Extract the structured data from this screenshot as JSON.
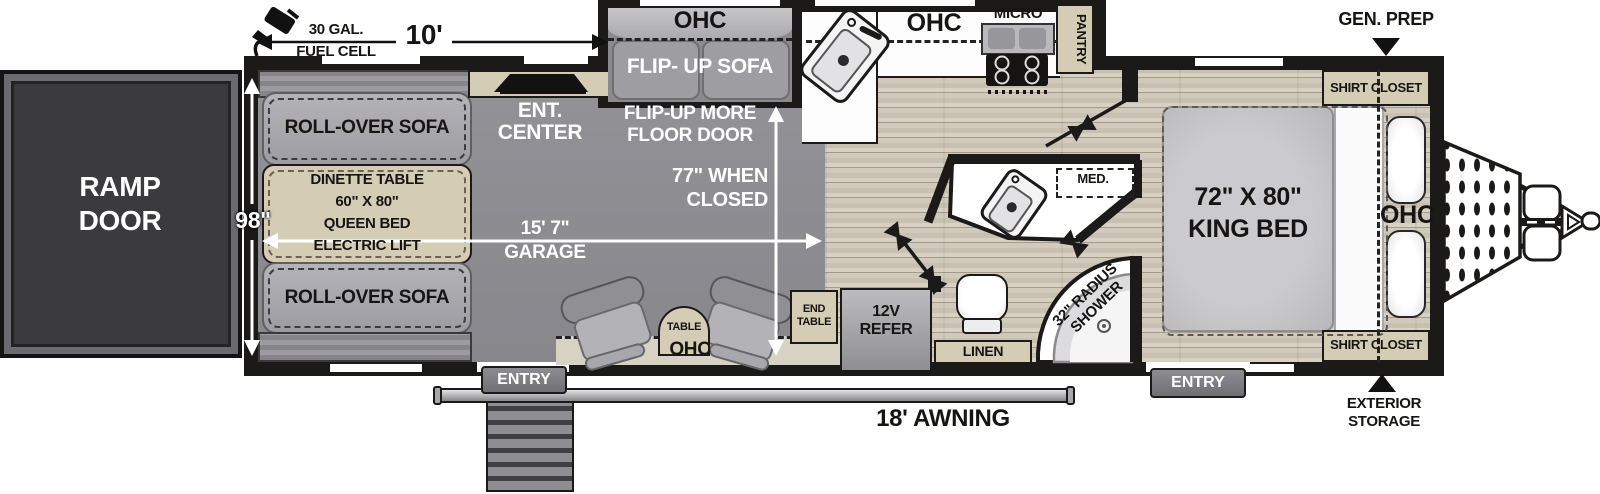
{
  "annotations": {
    "fuel": {
      "line1": "30 GAL.",
      "line2": "FUEL CELL"
    },
    "front_length": "10'",
    "body_width": "98\"",
    "garage_length": {
      "line1": "15' 7\"",
      "line2": "GARAGE"
    },
    "closed_height": {
      "line1": "77\" WHEN",
      "line2": "CLOSED"
    },
    "awning": "18' AWNING",
    "gen_prep": "GEN. PREP",
    "exterior_storage": {
      "line1": "EXTERIOR",
      "line2": "STORAGE"
    }
  },
  "exterior": {
    "ramp_door": {
      "line1": "RAMP",
      "line2": "DOOR"
    },
    "entry_garage": "ENTRY",
    "entry_main": "ENTRY"
  },
  "garage": {
    "rollover_sofa_top": "ROLL-OVER SOFA",
    "rollover_sofa_bottom": "ROLL-OVER SOFA",
    "dinette": {
      "line1": "DINETTE TABLE",
      "line2": "60\" X 80\"",
      "line3": "QUEEN BED",
      "line4": "ELECTRIC LIFT"
    },
    "ent_center": {
      "line1": "ENT.",
      "line2": "CENTER"
    },
    "flip_up_sofa_ohc": "OHC",
    "flip_up_sofa": "FLIP- UP SOFA",
    "flip_up_note": {
      "line1": "FLIP-UP MORE",
      "line2": "FLOOR DOOR"
    },
    "table": "TABLE",
    "ohc": "OHC",
    "end_table": {
      "line1": "END",
      "line2": "TABLE"
    }
  },
  "kitchen": {
    "ohc": "OHC",
    "micro": "MICRO",
    "pantry": "PANTRY",
    "refer": {
      "line1": "12V",
      "line2": "REFER"
    }
  },
  "bath": {
    "med": "MED.",
    "linen": "LINEN",
    "shower": {
      "line1": "32\" RADIUS",
      "line2": "SHOWER"
    }
  },
  "bedroom": {
    "bed": {
      "line1": "72\" X 80\"",
      "line2": "KING BED"
    },
    "ohc": "OHC",
    "shirt_closet_front": "SHIRT CLOSET",
    "shirt_closet_rear": "SHIRT CLOSET"
  },
  "colors": {
    "wall": "#1c1a18",
    "garage_floor": "#8a8a8f",
    "wood_floor": "#ccc4b5",
    "cabinet_tan": "#d5ccb5",
    "sofa_gray": "#a5a5aa"
  }
}
